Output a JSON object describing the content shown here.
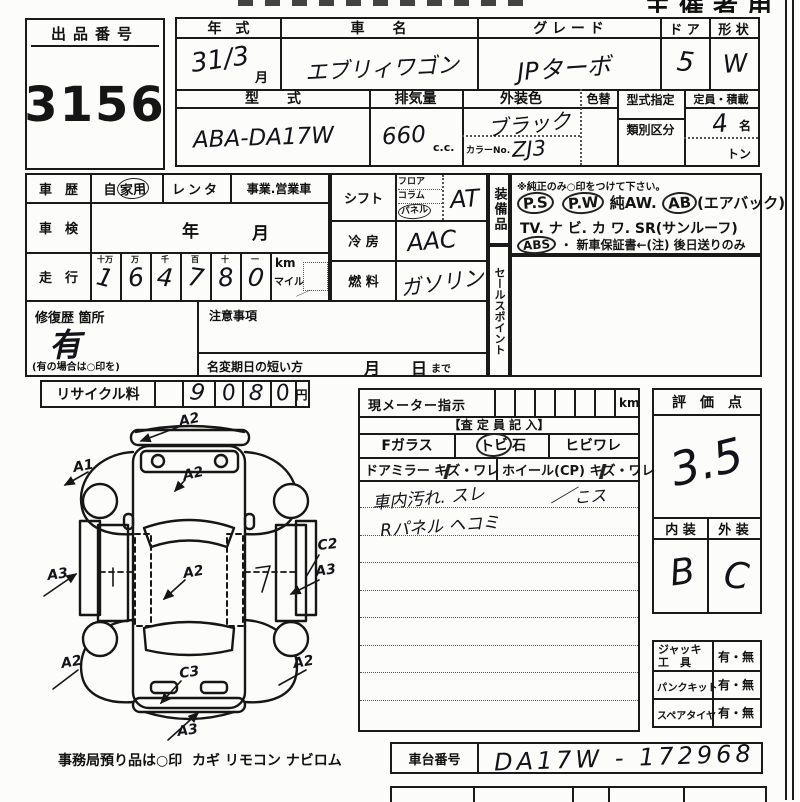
{
  "header": {
    "organizer_label": "主催者用",
    "lot_label": "出品番号",
    "lot_number": "3156"
  },
  "vehicle": {
    "year_label": "年　式",
    "year_value": "31/3",
    "month_suffix": "月",
    "name_label": "車　　名",
    "name_value": "エブリィワゴン",
    "grade_label": "グ レ ー ド",
    "grade_value": "JPターボ",
    "door_label": "ド ア",
    "door_value": "5",
    "shape_label": "形 状",
    "shape_value": "W",
    "model_label": "型　　式",
    "model_value": "ABA-DA17W",
    "disp_label": "排気量",
    "disp_value": "660",
    "disp_unit": "c.c.",
    "color_label": "外装色",
    "color_change_label": "色替",
    "color_value": "ブラック",
    "color_no_label": "カラーNo.",
    "color_no_value": "ZJ3",
    "type_desig_label": "型式指定",
    "class_label": "類別区分",
    "capacity_label": "定員・積載",
    "capacity_value": "4",
    "capacity_unit": "名",
    "ton_label": "トン"
  },
  "history": {
    "label": "車　歴",
    "private_prefix": "自",
    "private_circled": "家用",
    "rental": "レンタ",
    "business": "事業.営業車",
    "inspection_label": "車　検",
    "inspection_year": "年",
    "inspection_month": "月",
    "mileage_label": "走　行",
    "digit_headers": [
      "十万",
      "万",
      "千",
      "百",
      "十",
      "一"
    ],
    "digits": [
      "1",
      "6",
      "4",
      "7",
      "8",
      "0"
    ],
    "km_label": "km",
    "mile_label": "マイル",
    "tick": "／",
    "repair_label": "修復歴 箇所",
    "repair_value": "有",
    "repair_note": "(有の場合は○印を)",
    "caution_label": "注意事項",
    "name_change_label": "名変期日の短い方",
    "month_label": "月",
    "day_label": "日",
    "until_label": "まで"
  },
  "specs": {
    "shift_label": "シフト",
    "shift_options": [
      "フロア",
      "コラム",
      "パネル"
    ],
    "shift_value": "AT",
    "ac_label": "冷 房",
    "ac_value": "AAC",
    "fuel_label": "燃 料",
    "fuel_value": "ガソリン"
  },
  "equipment": {
    "strip_label": "装備品",
    "sales_strip_label": "セールスポイント",
    "note": "※純正のみ○印をつけて下さい。",
    "ps": "P.S",
    "pw": "P.W",
    "aw": "純AW.",
    "ab": "AB",
    "airbag": "(エアバック)",
    "line3": "TV.  ナ ビ.  カ ワ.  SR(サンルーフ)",
    "abs": "ABS",
    "line4_rest": "・ 新車保証書←(注) 後日送りのみ"
  },
  "recycle": {
    "label": "リサイクル料",
    "digits": [
      "9",
      "0",
      "8",
      "0"
    ],
    "unit": "円"
  },
  "diagram": {
    "marks": {
      "top_a2": "A2",
      "front_left_a1": "A1",
      "hood_a2": "A2",
      "left_a3": "A3",
      "cabin_a2": "A2",
      "right_c2": "C2",
      "right_a3": "A3",
      "rear_left_a2": "A2",
      "rear_right_a2": "A2",
      "rear_c3": "C3",
      "rear_a3": "A3",
      "panel_mark_left": "|",
      "panel_mark_right": "7"
    },
    "footer_note": "事務局預り品は○印",
    "footer_items": "カギ  リモコン  ナビロム"
  },
  "meter": {
    "label": "現メーター指示",
    "unit": "km",
    "inspector_label": "【査 定 員 記 入】",
    "fglass_label": "Fガラス",
    "stone_prefix": "トビ",
    "stone_suffix": "石",
    "crack_label": "ヒビワレ",
    "mirror_label": "ドアミラー",
    "mirror_scratch": "キズ",
    "mirror_crack": "・ワレ",
    "wheel_label": "ホイール(CP)",
    "wheel_scratch": "キズ",
    "wheel_crack": "・ワレ",
    "note1": "車内汚れ. スレ",
    "note1b": "こス",
    "check": "／",
    "note2": "Rパネル ヘコミ"
  },
  "rating": {
    "label": "評　価　点",
    "score": "3.5",
    "interior_label": "内 装",
    "exterior_label": "外 装",
    "interior_value": "B",
    "exterior_value": "C"
  },
  "tools": {
    "rows": [
      {
        "label": "ジャッキ",
        "label2": "工　具",
        "value": "有・無"
      },
      {
        "label": "パンクキット",
        "label2": "",
        "value": "有・無"
      },
      {
        "label": "スペアタイヤ",
        "label2": "",
        "value": "有・無"
      }
    ]
  },
  "chassis": {
    "label": "車台番号",
    "value": "DA17W - 172968"
  }
}
